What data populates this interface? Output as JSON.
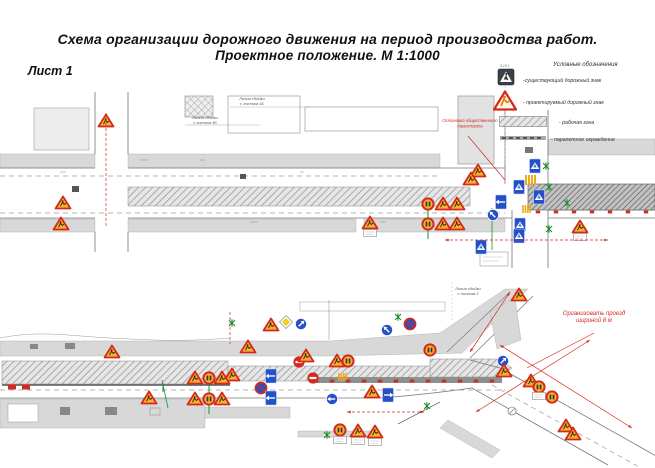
{
  "title": {
    "line1": "Схема организации дорожного движения на период производства работ.",
    "line2": "Проектное положение. М 1:1000"
  },
  "sheet_label": "Лист 1",
  "legend": {
    "heading": "Условные обозначения",
    "existing_sign_code": "5.19.1",
    "items": [
      {
        "icon": "existing-sign-icon",
        "label": "-существующий дорожный знак"
      },
      {
        "icon": "projected-sign-icon",
        "label": "- проектируемый дорожный знак"
      },
      {
        "icon": "work-zone-swatch",
        "label": "- рабочая зона"
      },
      {
        "icon": "parapet-swatch",
        "label": "- парапетное ограждение"
      }
    ]
  },
  "colors": {
    "warn_fill": "#F7B233",
    "warn_border": "#D42A1E",
    "blue": "#2450C8",
    "red": "#D42A1E",
    "green": "#1E8F2E",
    "yellow": "#F7D117",
    "sidewalk": "#d8d8d8",
    "linework": "#777777"
  },
  "diagrams": {
    "top": {
      "labels": [
        {
          "x": 252,
          "y": 100,
          "size": 4,
          "color": "#555",
          "lines": [
            "Линия сбойки",
            "с листом 1Б"
          ]
        },
        {
          "x": 205,
          "y": 119,
          "size": 4,
          "color": "#555",
          "lines": [
            "Линия сбойки",
            "с листом 1Б"
          ]
        },
        {
          "x": 470,
          "y": 122,
          "size": 4.2,
          "color": "#D42A1E",
          "lines": [
            "Остановка общественного",
            "транспорта"
          ]
        }
      ],
      "signs": [
        {
          "t": "warn",
          "x": 106,
          "y": 121
        },
        {
          "t": "warn",
          "x": 63,
          "y": 203
        },
        {
          "t": "warn",
          "x": 61,
          "y": 224
        },
        {
          "t": "warn",
          "x": 370,
          "y": 223
        },
        {
          "t": "board",
          "x": 370,
          "y": 233
        },
        {
          "t": "warn",
          "x": 478,
          "y": 171
        },
        {
          "t": "warn",
          "x": 471,
          "y": 179
        },
        {
          "t": "warn",
          "x": 580,
          "y": 227
        },
        {
          "t": "board",
          "x": 580,
          "y": 237
        },
        {
          "t": "speed",
          "x": 428,
          "y": 204
        },
        {
          "t": "warn",
          "x": 443,
          "y": 204
        },
        {
          "t": "warn",
          "x": 457,
          "y": 204
        },
        {
          "t": "speed",
          "x": 428,
          "y": 224
        },
        {
          "t": "warn",
          "x": 443,
          "y": 224
        },
        {
          "t": "warn",
          "x": 457,
          "y": 224
        },
        {
          "t": "post",
          "x": 428,
          "y": 210
        },
        {
          "t": "post",
          "x": 428,
          "y": 230
        },
        {
          "t": "brect",
          "x": 535,
          "y": 166
        },
        {
          "t": "brect",
          "x": 519,
          "y": 187
        },
        {
          "t": "brect",
          "x": 539,
          "y": 197
        },
        {
          "t": "brect",
          "x": 520,
          "y": 225
        },
        {
          "t": "brect",
          "x": 519,
          "y": 236
        },
        {
          "t": "brect",
          "x": 481,
          "y": 247
        },
        {
          "t": "brect-arrow",
          "x": 501,
          "y": 202,
          "r": -90
        },
        {
          "t": "bcirc-arrow",
          "x": 493,
          "y": 215,
          "r": -45
        },
        {
          "t": "zebra",
          "x": 531,
          "y": 180
        },
        {
          "t": "zebra",
          "x": 527,
          "y": 209,
          "s": 0.8
        },
        {
          "t": "tree",
          "x": 546,
          "y": 166
        },
        {
          "t": "tree",
          "x": 549,
          "y": 187
        },
        {
          "t": "tree",
          "x": 567,
          "y": 203
        },
        {
          "t": "tree",
          "x": 549,
          "y": 229
        },
        {
          "t": "tick",
          "x": 538,
          "y": 212
        },
        {
          "t": "tick",
          "x": 556,
          "y": 212
        },
        {
          "t": "tick",
          "x": 574,
          "y": 212
        },
        {
          "t": "tick",
          "x": 592,
          "y": 212
        },
        {
          "t": "tick",
          "x": 610,
          "y": 212
        },
        {
          "t": "tick",
          "x": 628,
          "y": 212
        },
        {
          "t": "tick",
          "x": 646,
          "y": 212
        }
      ],
      "redlines": [
        {
          "x1": 106,
          "y1": 113,
          "x2": 106,
          "y2": 226,
          "d": 1
        },
        {
          "x1": 445,
          "y1": 240,
          "x2": 608,
          "y2": 240,
          "d": 1,
          "a": 1
        },
        {
          "x1": 468,
          "y1": 136,
          "x2": 505,
          "y2": 180
        }
      ]
    },
    "bottom": {
      "labels": [
        {
          "x": 468,
          "y": 290,
          "size": 4,
          "color": "#555",
          "lines": [
            "Линия сбойки",
            "с листом 2"
          ]
        },
        {
          "x": 594,
          "y": 315,
          "size": 6,
          "color": "#D42A1E",
          "lines": [
            "Организовать проезд",
            "шириной 8 м"
          ]
        }
      ],
      "signs": [
        {
          "t": "warn",
          "x": 112,
          "y": 352
        },
        {
          "t": "warn",
          "x": 248,
          "y": 347
        },
        {
          "t": "warn",
          "x": 271,
          "y": 325
        },
        {
          "t": "diamond",
          "x": 286,
          "y": 322
        },
        {
          "t": "bcirc-arrow",
          "x": 301,
          "y": 324,
          "r": 45
        },
        {
          "t": "warn",
          "x": 232,
          "y": 375
        },
        {
          "t": "brect-arrow",
          "x": 271,
          "y": 376,
          "r": -90
        },
        {
          "t": "bcirc-slash",
          "x": 261,
          "y": 388
        },
        {
          "t": "brect-arrow",
          "x": 271,
          "y": 398,
          "r": -90
        },
        {
          "t": "warn",
          "x": 149,
          "y": 398
        },
        {
          "t": "warn",
          "x": 195,
          "y": 378
        },
        {
          "t": "speed",
          "x": 209,
          "y": 378
        },
        {
          "t": "warn",
          "x": 222,
          "y": 378
        },
        {
          "t": "warn",
          "x": 195,
          "y": 399
        },
        {
          "t": "speed",
          "x": 209,
          "y": 399
        },
        {
          "t": "warn",
          "x": 222,
          "y": 399
        },
        {
          "t": "post",
          "x": 209,
          "y": 384
        },
        {
          "t": "post",
          "x": 209,
          "y": 405
        },
        {
          "t": "post",
          "x": 163,
          "y": 383
        },
        {
          "t": "red-circle",
          "x": 299,
          "y": 362
        },
        {
          "t": "red-circle",
          "x": 313,
          "y": 378
        },
        {
          "t": "warn",
          "x": 306,
          "y": 356
        },
        {
          "t": "warn",
          "x": 337,
          "y": 361
        },
        {
          "t": "speed",
          "x": 348,
          "y": 361
        },
        {
          "t": "bcirc-arrow",
          "x": 332,
          "y": 399,
          "r": -90
        },
        {
          "t": "warn",
          "x": 372,
          "y": 392
        },
        {
          "t": "brect-arrow",
          "x": 388,
          "y": 395,
          "r": 90
        },
        {
          "t": "bcirc-slash",
          "x": 410,
          "y": 324
        },
        {
          "t": "bcirc-arrow",
          "x": 387,
          "y": 330,
          "r": -45
        },
        {
          "t": "speed",
          "x": 430,
          "y": 350
        },
        {
          "t": "warn",
          "x": 519,
          "y": 295
        },
        {
          "t": "bcirc-arrow",
          "x": 503,
          "y": 361,
          "r": 45
        },
        {
          "t": "warn",
          "x": 504,
          "y": 371
        },
        {
          "t": "warn",
          "x": 531,
          "y": 381
        },
        {
          "t": "speed",
          "x": 539,
          "y": 387
        },
        {
          "t": "board",
          "x": 539,
          "y": 396
        },
        {
          "t": "speed",
          "x": 552,
          "y": 397
        },
        {
          "t": "warn",
          "x": 566,
          "y": 426
        },
        {
          "t": "warn",
          "x": 573,
          "y": 434
        },
        {
          "t": "speed",
          "x": 340,
          "y": 430
        },
        {
          "t": "board",
          "x": 340,
          "y": 440
        },
        {
          "t": "warn",
          "x": 358,
          "y": 431
        },
        {
          "t": "board",
          "x": 358,
          "y": 441
        },
        {
          "t": "warn",
          "x": 375,
          "y": 432
        },
        {
          "t": "board",
          "x": 375,
          "y": 442
        },
        {
          "t": "tree",
          "x": 232,
          "y": 323
        },
        {
          "t": "tree",
          "x": 398,
          "y": 317
        },
        {
          "t": "tree",
          "x": 327,
          "y": 435
        },
        {
          "t": "tree",
          "x": 427,
          "y": 406
        },
        {
          "t": "zebra",
          "x": 343,
          "y": 377,
          "s": 0.8
        },
        {
          "t": "tick",
          "x": 316,
          "y": 381
        },
        {
          "t": "tick",
          "x": 332,
          "y": 381
        },
        {
          "t": "tick",
          "x": 348,
          "y": 381
        },
        {
          "t": "tick",
          "x": 364,
          "y": 381
        },
        {
          "t": "tick",
          "x": 380,
          "y": 381
        },
        {
          "t": "tick",
          "x": 396,
          "y": 381
        },
        {
          "t": "tick",
          "x": 412,
          "y": 381
        },
        {
          "t": "tick",
          "x": 428,
          "y": 381
        },
        {
          "t": "tick",
          "x": 444,
          "y": 381
        },
        {
          "t": "tick",
          "x": 460,
          "y": 381
        },
        {
          "t": "tick",
          "x": 476,
          "y": 381
        },
        {
          "t": "tick",
          "x": 492,
          "y": 381
        },
        {
          "t": "redblock",
          "x": 12,
          "y": 387
        },
        {
          "t": "redblock",
          "x": 26,
          "y": 387
        },
        {
          "t": "circle-sym",
          "x": 512,
          "y": 411
        }
      ],
      "redlines": [
        {
          "x1": 594,
          "y1": 333,
          "x2": 527,
          "y2": 368
        },
        {
          "x1": 500,
          "y1": 345,
          "x2": 632,
          "y2": 428,
          "a": 1
        },
        {
          "x1": 510,
          "y1": 292,
          "x2": 470,
          "y2": 352,
          "a": 1
        },
        {
          "x1": 347,
          "y1": 412,
          "x2": 424,
          "y2": 412,
          "d": 1,
          "a": 1
        },
        {
          "x1": 230,
          "y1": 312,
          "x2": 230,
          "y2": 344,
          "d": 1
        },
        {
          "x1": 590,
          "y1": 340,
          "x2": 476,
          "y2": 412,
          "a": 1
        }
      ]
    }
  }
}
